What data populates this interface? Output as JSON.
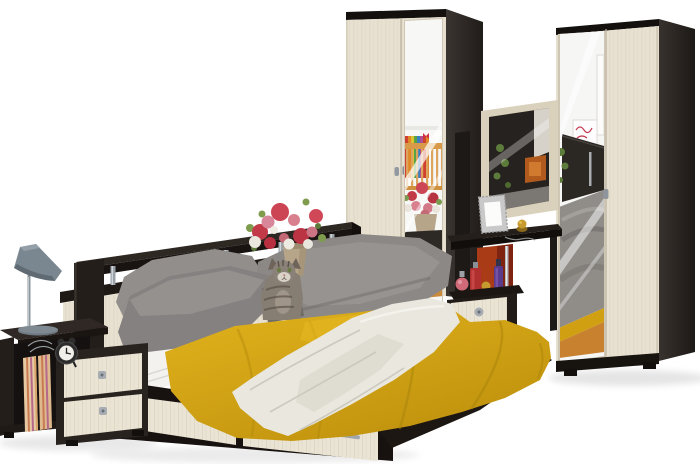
{
  "image": {
    "kind": "product-photo",
    "subject": "Bedroom furniture set in dark wenge and light oak: double bed with storage headboard and drawers, two mirrored wardrobes, dressing table with mirror, bedside cabinet, table lamp, flowers and a cat",
    "background_color": "#ffffff"
  },
  "palette": {
    "wenge_dark": "#221d1a",
    "wenge_side": "#332d29",
    "light_wood": "#e8e1d1",
    "wood_grain": "#ddd5c1",
    "mirror_white": "#f6f6f5",
    "blanket_yellow": "#d2a213",
    "throw_cream": "#e9e7de",
    "pillow_gray": "#8d8a87",
    "sheet_white": "#f3f2ef",
    "lamp_gray": "#7b8790",
    "chrome": "#b8bcc0",
    "floor_reflection_orange": "#c8812f",
    "vase_red": "#a93c16",
    "flower_red": "#c23a48",
    "flower_pink": "#d8808e",
    "leaf_green": "#7a9a4e"
  },
  "objects": {
    "wardrobe_left": {
      "label": "Two-door wardrobe with mirror door (left)",
      "doors": 2,
      "mirrored_doors": 1
    },
    "wardrobe_right": {
      "label": "Two-door wardrobe with mirror door (right)",
      "doors": 2,
      "mirrored_doors": 1
    },
    "vanity": {
      "label": "Dressing table with mirror, photo frame, perfume bottles and red vase",
      "drawers": 1
    },
    "bed": {
      "label": "Double bed with yellow blanket, cream throw, white sheet and storage drawers",
      "drawers": 2
    },
    "headboard_shelf": {
      "label": "Storage headboard shelf with chrome supports and remote control"
    },
    "nightstand_left": {
      "label": "Bedside cabinet with two drawers, alarm clock and striped storage boxes",
      "drawers": 2
    },
    "lamp": {
      "label": "Gray cone table lamp"
    },
    "alarm_clock": {
      "label": "Black twin-bell alarm clock"
    },
    "flowers": {
      "label": "Bouquet of red and pink flowers in a beige vase"
    },
    "cat": {
      "label": "Gray tabby cat sitting on the bed"
    },
    "photo_frame": {
      "label": "Silver photo frame on the dressing table"
    }
  }
}
